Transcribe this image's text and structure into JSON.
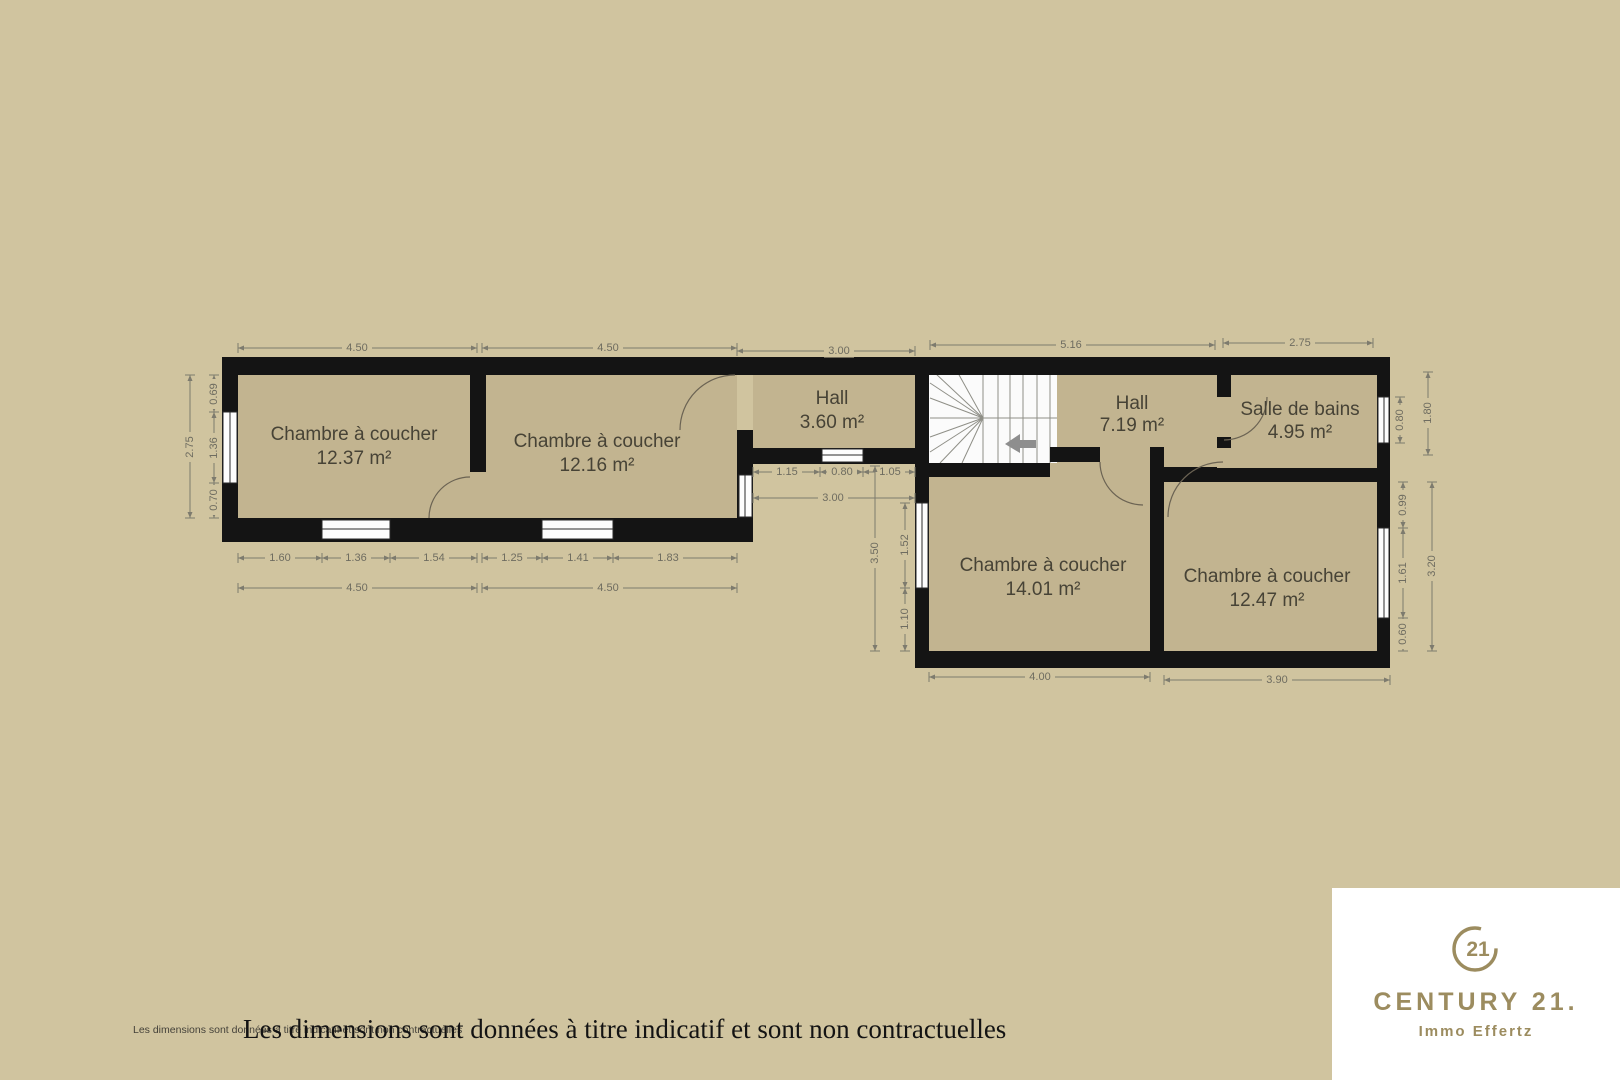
{
  "colors": {
    "bg": "#d0c49f",
    "room": "#c2b490",
    "wall": "#141414",
    "paper": "#ffffff",
    "dimline": "#7d7b6e",
    "dimtext": "#6e6c60",
    "label": "#474336",
    "gold": "#9c8c5f",
    "stairline": "#8f8f87",
    "arrow": "#8e8e8e",
    "door": "#6b6353",
    "ink": "#131313",
    "smalltext": "#45423a"
  },
  "plan": {
    "rooms": [
      {
        "name": "Chambre à coucher",
        "area": "12.37 m²"
      },
      {
        "name": "Chambre à coucher",
        "area": "12.16 m²"
      },
      {
        "name": "Hall",
        "area": "3.60 m²"
      },
      {
        "name": "Hall",
        "area": "7.19 m²"
      },
      {
        "name": "Salle de bains",
        "area": "4.95 m²"
      },
      {
        "name": "Chambre à coucher",
        "area": "14.01 m²"
      },
      {
        "name": "Chambre à coucher",
        "area": "12.47 m²"
      }
    ],
    "dims": [
      {
        "t": "4.50",
        "x1": 238,
        "y1": 348,
        "x2": 477,
        "y2": 348,
        "lx": 357,
        "ly": 348
      },
      {
        "t": "4.50",
        "x1": 482,
        "y1": 348,
        "x2": 737,
        "y2": 348,
        "lx": 608,
        "ly": 348
      },
      {
        "t": "3.00",
        "x1": 737,
        "y1": 351,
        "x2": 915,
        "y2": 351,
        "lx": 839,
        "ly": 351
      },
      {
        "t": "5.16",
        "x1": 930,
        "y1": 345,
        "x2": 1215,
        "y2": 345,
        "lx": 1071,
        "ly": 345
      },
      {
        "t": "2.75",
        "x1": 1223,
        "y1": 343,
        "x2": 1373,
        "y2": 343,
        "lx": 1300,
        "ly": 343
      },
      {
        "t": "2.75",
        "x1": 190,
        "y1": 375,
        "x2": 190,
        "y2": 518,
        "lx": 190,
        "ly": 447,
        "r": 1
      },
      {
        "t": "0.69",
        "x1": 214,
        "y1": 375,
        "x2": 214,
        "y2": 412,
        "lx": 214,
        "ly": 394,
        "r": 1
      },
      {
        "t": "1.36",
        "x1": 214,
        "y1": 412,
        "x2": 214,
        "y2": 483,
        "lx": 214,
        "ly": 448,
        "r": 1
      },
      {
        "t": "0.70",
        "x1": 214,
        "y1": 483,
        "x2": 214,
        "y2": 518,
        "lx": 214,
        "ly": 500,
        "r": 1
      },
      {
        "t": "1.60",
        "x1": 238,
        "y1": 558,
        "x2": 322,
        "y2": 558,
        "lx": 280,
        "ly": 558
      },
      {
        "t": "1.36",
        "x1": 322,
        "y1": 558,
        "x2": 390,
        "y2": 558,
        "lx": 356,
        "ly": 558
      },
      {
        "t": "1.54",
        "x1": 390,
        "y1": 558,
        "x2": 477,
        "y2": 558,
        "lx": 434,
        "ly": 558
      },
      {
        "t": "1.25",
        "x1": 482,
        "y1": 558,
        "x2": 542,
        "y2": 558,
        "lx": 512,
        "ly": 558
      },
      {
        "t": "1.41",
        "x1": 542,
        "y1": 558,
        "x2": 613,
        "y2": 558,
        "lx": 578,
        "ly": 558
      },
      {
        "t": "1.83",
        "x1": 613,
        "y1": 558,
        "x2": 737,
        "y2": 558,
        "lx": 668,
        "ly": 558
      },
      {
        "t": "4.50",
        "x1": 238,
        "y1": 588,
        "x2": 477,
        "y2": 588,
        "lx": 357,
        "ly": 588
      },
      {
        "t": "4.50",
        "x1": 482,
        "y1": 588,
        "x2": 737,
        "y2": 588,
        "lx": 608,
        "ly": 588
      },
      {
        "t": "1.15",
        "x1": 753,
        "y1": 472,
        "x2": 820,
        "y2": 472,
        "lx": 787,
        "ly": 472
      },
      {
        "t": "0.80",
        "x1": 820,
        "y1": 472,
        "x2": 863,
        "y2": 472,
        "lx": 842,
        "ly": 472
      },
      {
        "t": "1.05",
        "x1": 863,
        "y1": 472,
        "x2": 915,
        "y2": 472,
        "lx": 890,
        "ly": 472
      },
      {
        "t": "3.00",
        "x1": 753,
        "y1": 498,
        "x2": 915,
        "y2": 498,
        "lx": 833,
        "ly": 498
      },
      {
        "t": "3.50",
        "x1": 875,
        "y1": 466,
        "x2": 875,
        "y2": 651,
        "lx": 875,
        "ly": 553,
        "r": 1
      },
      {
        "t": "1.52",
        "x1": 905,
        "y1": 503,
        "x2": 905,
        "y2": 588,
        "lx": 905,
        "ly": 545,
        "r": 1
      },
      {
        "t": "1.10",
        "x1": 905,
        "y1": 588,
        "x2": 905,
        "y2": 651,
        "lx": 905,
        "ly": 619,
        "r": 1
      },
      {
        "t": "0.80",
        "x1": 1400,
        "y1": 397,
        "x2": 1400,
        "y2": 443,
        "lx": 1400,
        "ly": 420,
        "r": 1
      },
      {
        "t": "1.80",
        "x1": 1428,
        "y1": 372,
        "x2": 1428,
        "y2": 455,
        "lx": 1428,
        "ly": 413,
        "r": 1
      },
      {
        "t": "0.99",
        "x1": 1403,
        "y1": 482,
        "x2": 1403,
        "y2": 528,
        "lx": 1403,
        "ly": 505,
        "r": 1
      },
      {
        "t": "1.61",
        "x1": 1403,
        "y1": 528,
        "x2": 1403,
        "y2": 618,
        "lx": 1403,
        "ly": 573,
        "r": 1
      },
      {
        "t": "0.60",
        "x1": 1403,
        "y1": 618,
        "x2": 1403,
        "y2": 651,
        "lx": 1403,
        "ly": 634,
        "r": 1
      },
      {
        "t": "3.20",
        "x1": 1432,
        "y1": 482,
        "x2": 1432,
        "y2": 651,
        "lx": 1432,
        "ly": 566,
        "r": 1
      },
      {
        "t": "4.00",
        "x1": 929,
        "y1": 677,
        "x2": 1150,
        "y2": 677,
        "lx": 1040,
        "ly": 677
      },
      {
        "t": "3.90",
        "x1": 1164,
        "y1": 680,
        "x2": 1390,
        "y2": 680,
        "lx": 1277,
        "ly": 680
      }
    ]
  },
  "footer": {
    "disclaimer_small": "Les dimensions sont données à titre indicatif et sont non contractuelles",
    "disclaimer_large": "Les dimensions sont données à titre indicatif et sont non contractuelles"
  },
  "branding": {
    "seal_number": "21",
    "wordmark": "CENTURY 21.",
    "subline": "Immo Effertz"
  }
}
